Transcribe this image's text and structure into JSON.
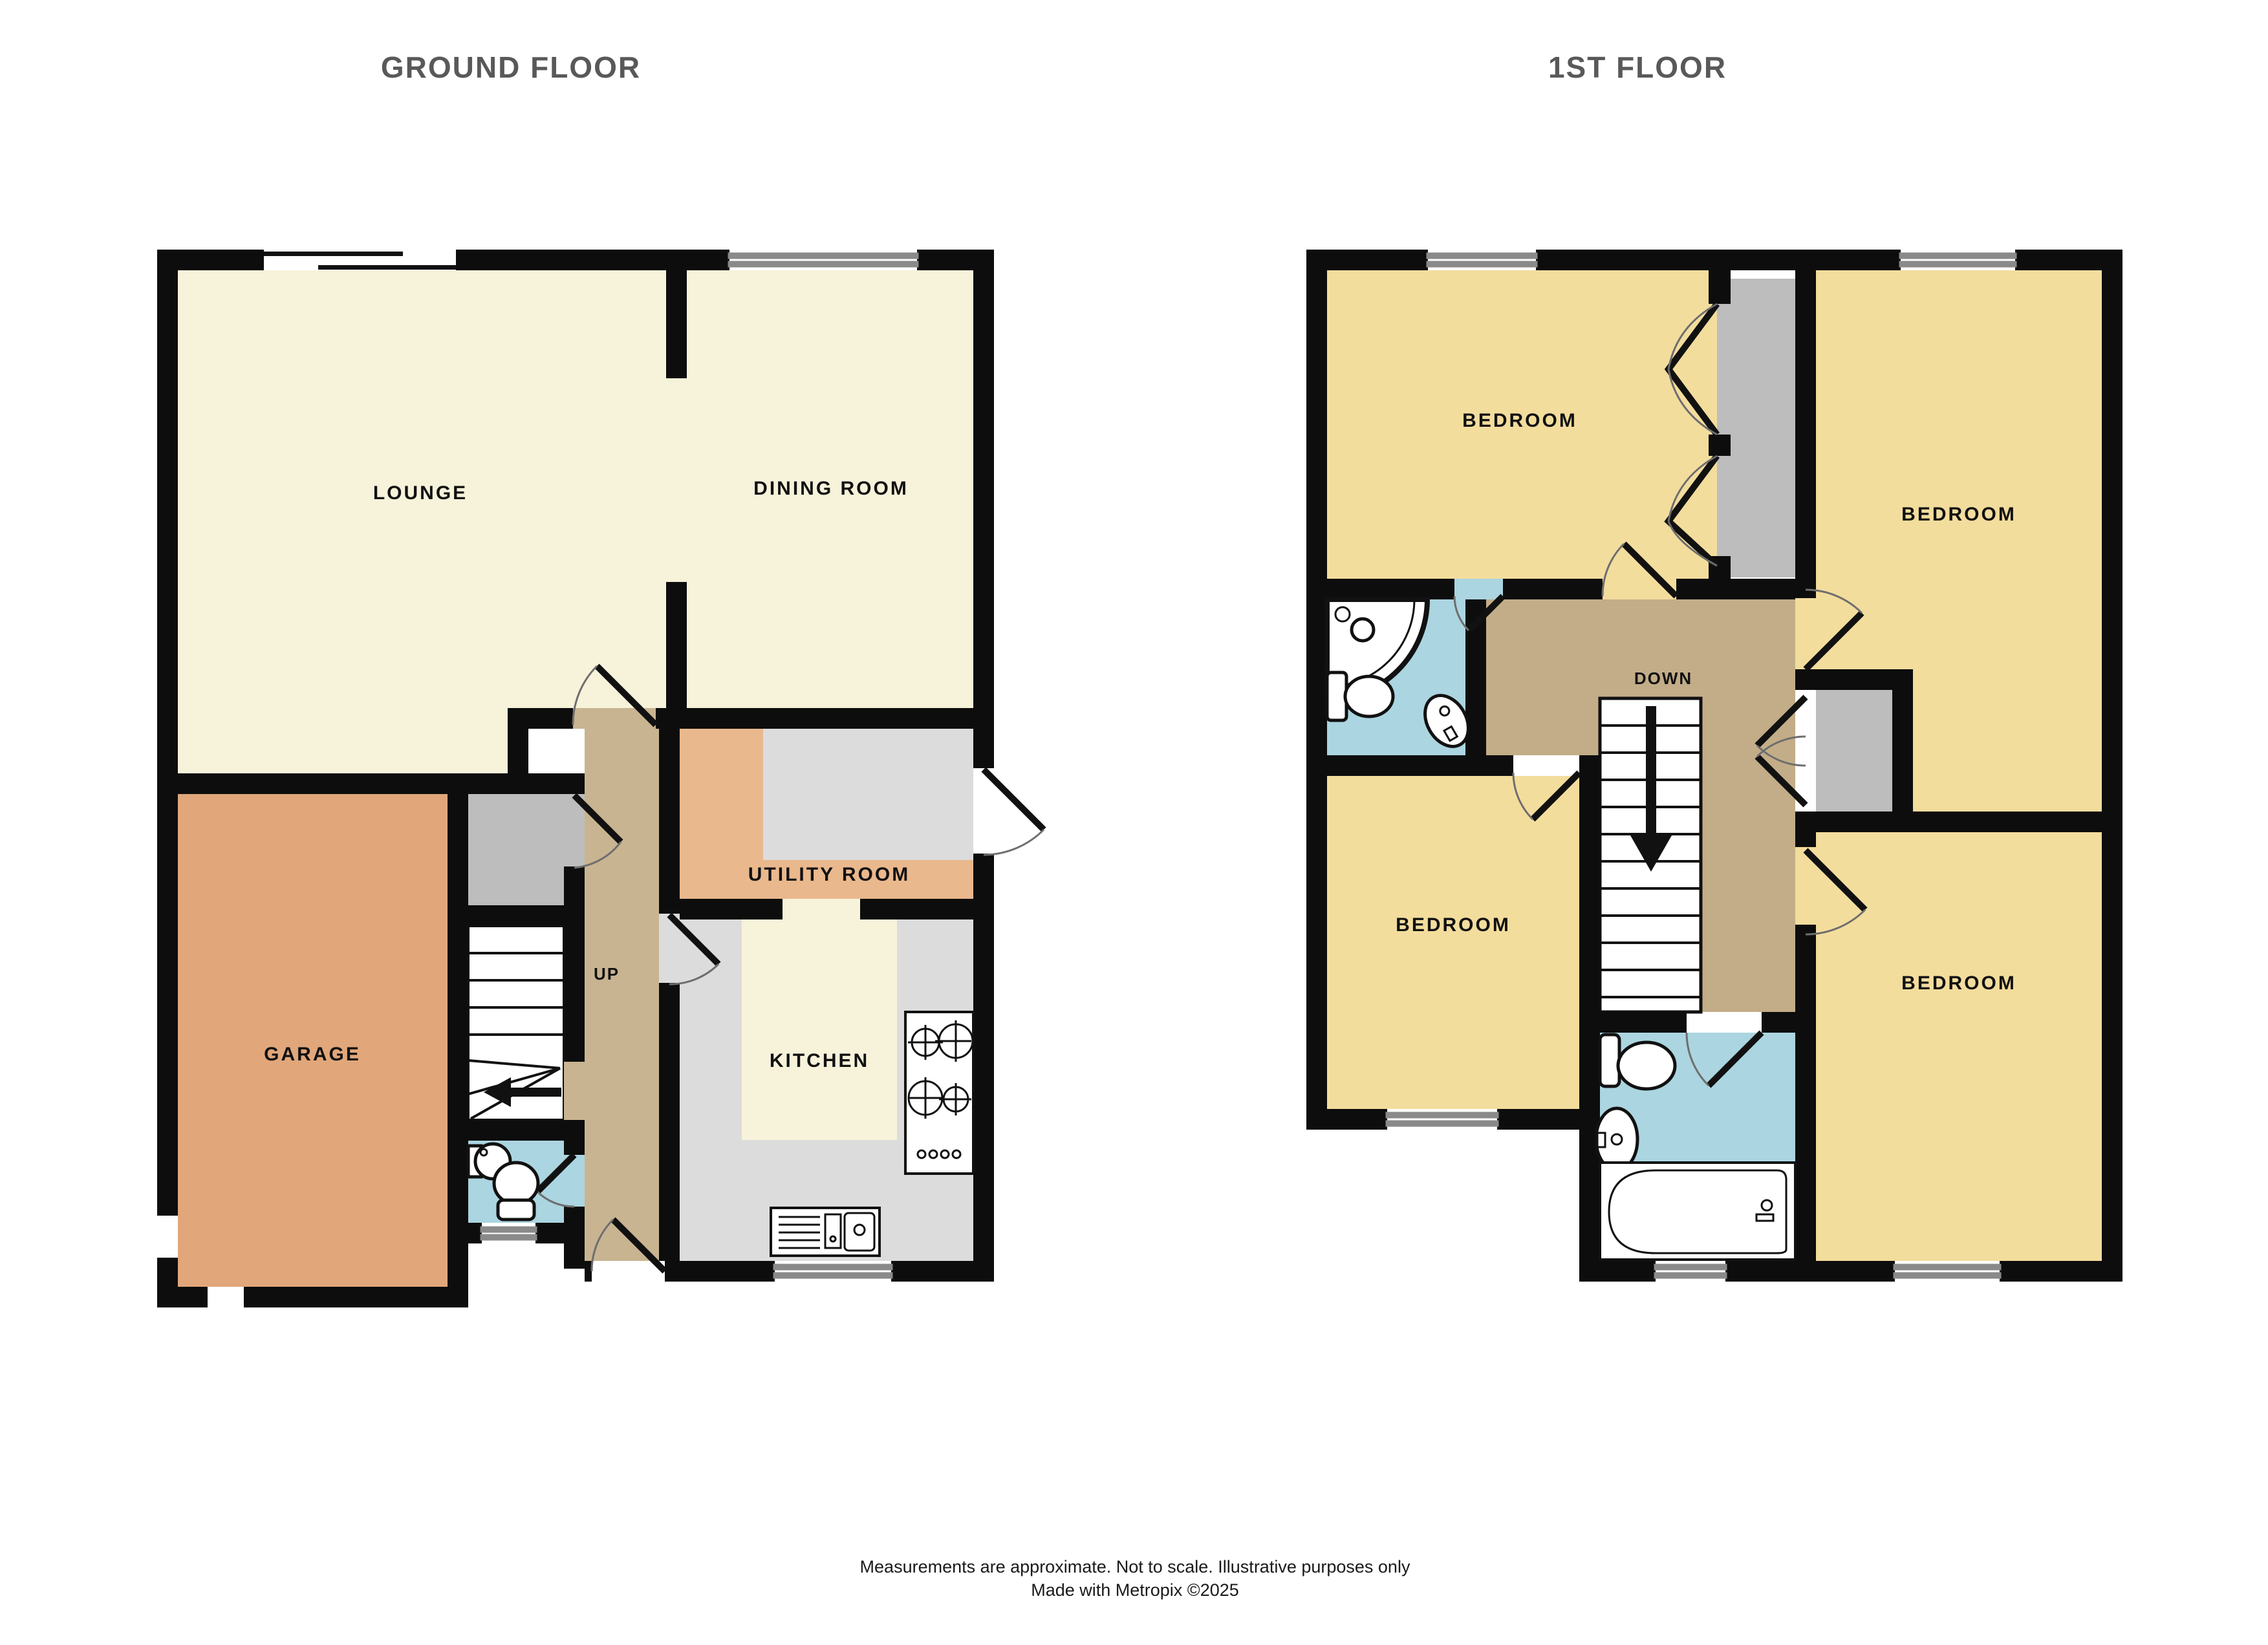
{
  "titles": {
    "ground": "GROUND FLOOR",
    "first": "1ST FLOOR"
  },
  "ground_floor": {
    "rooms": {
      "lounge": "LOUNGE",
      "dining": "DINING ROOM",
      "utility": "UTILITY ROOM",
      "kitchen": "KITCHEN",
      "garage": "GARAGE"
    },
    "stairs_label": "UP"
  },
  "first_floor": {
    "bedrooms": [
      "BEDROOM",
      "BEDROOM",
      "BEDROOM",
      "BEDROOM"
    ],
    "stairs_label": "DOWN"
  },
  "footer": {
    "line1": "Measurements are approximate.  Not to scale.  Illustrative purposes only",
    "line2": "Made with Metropix ©2025"
  },
  "colors": {
    "wall": "#0d0d0d",
    "cream": "#f7f2da",
    "bedroom": "#f3dd9d",
    "garage": "#e1a77b",
    "utility": "#eab88d",
    "hall": "#c9b491",
    "landing": "#c3ad88",
    "wet": "#abd5e0",
    "wardrobe": "#bdbdbd",
    "counter": "#dcdcdc",
    "stairs": "#ffffff",
    "title_text": "#595959",
    "label_text": "#111111"
  }
}
